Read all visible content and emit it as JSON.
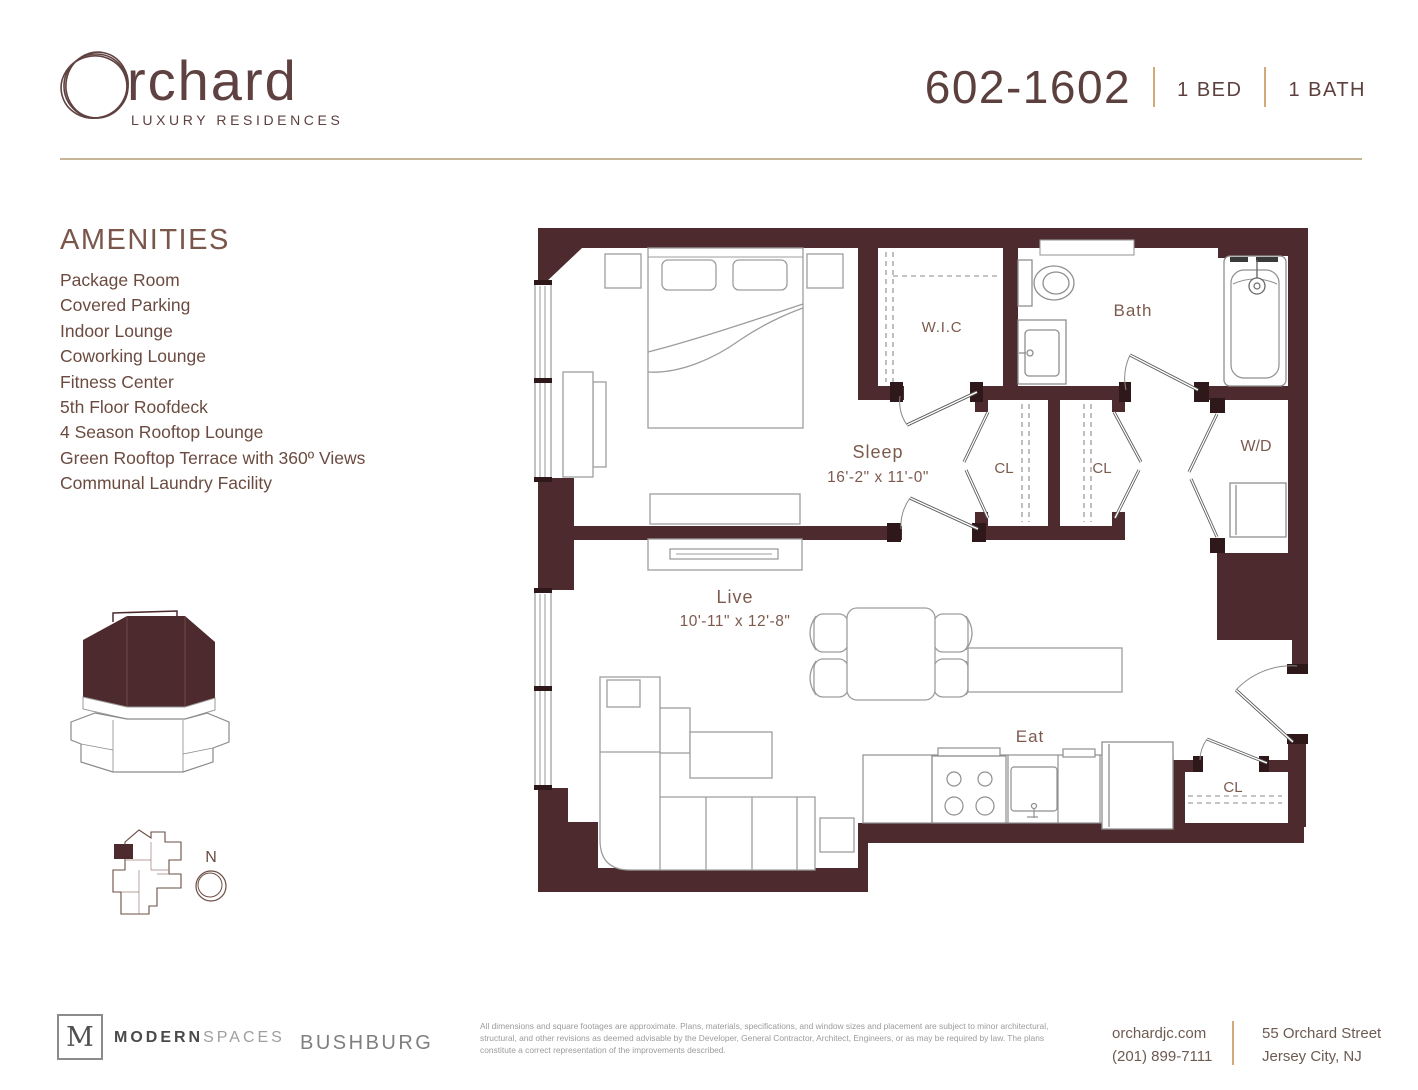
{
  "brand": {
    "wordmark": "rchard",
    "tagline": "LUXURY RESIDENCES"
  },
  "unit": {
    "number": "602-1602",
    "bed": "1 BED",
    "bath": "1 BATH"
  },
  "amenities": {
    "title": "AMENITIES",
    "items": [
      "Package Room",
      "Covered Parking",
      "Indoor Lounge",
      "Coworking Lounge",
      "Fitness Center",
      "5th Floor Roofdeck",
      "4 Season Rooftop Lounge",
      "Green Rooftop Terrace with 360º Views",
      "Communal Laundry Facility"
    ]
  },
  "floorplan": {
    "labels": {
      "sleep": "Sleep",
      "sleep_dims": "16'-2\" x 11'-0\"",
      "live": "Live",
      "live_dims": "10'-11\" x 12'-8\"",
      "wic": "W.I.C",
      "bath": "Bath",
      "closet1": "CL",
      "closet2": "CL",
      "closet_entry": "CL",
      "washer_dryer": "W/D",
      "eat": "Eat"
    },
    "compass": "N"
  },
  "footer": {
    "broker_letter": "M",
    "broker_bold": "MODERN",
    "broker_light": "SPACES",
    "developer": "BUSHBURG",
    "disclaimer": "All dimensions and square footages are approximate. Plans, materials, specifications, and window sizes and placement are subject to minor architectural, structural, and other revisions as deemed advisable by the Developer, General Contractor, Architect, Engineers, or as may be required by law. The plans constitute a correct representation of the improvements described.",
    "website": "orchardjc.com",
    "phone": "(201) 899-7111",
    "address1": "55 Orchard Street",
    "address2": "Jersey City, NJ"
  },
  "colors": {
    "wall": "#4d2a2d",
    "accent_tan": "#d2a87c",
    "rule_tan": "#c6b596",
    "text_maroon": "#6b4b40"
  }
}
